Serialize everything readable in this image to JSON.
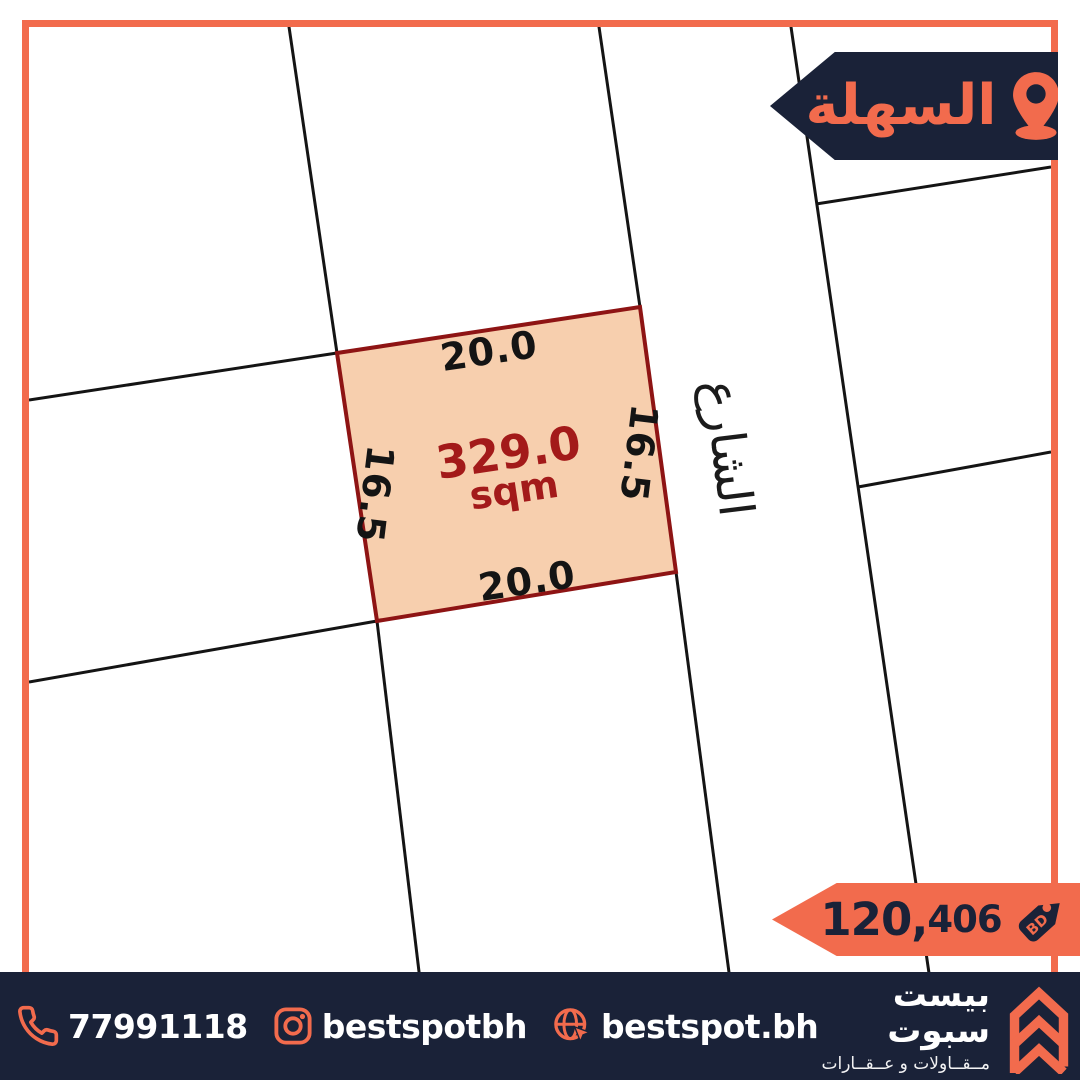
{
  "colors": {
    "accent_orange": "#f26b4d",
    "brand_navy": "#1a2238",
    "plot_fill": "#f7cfae",
    "plot_border": "#8e1414",
    "plot_text_red": "#a31a1a",
    "map_line_black": "#141414",
    "text_white": "#ffffff"
  },
  "location_badge": {
    "label": "السهلة",
    "icon": "location-pin"
  },
  "map": {
    "street_label": "الشارع",
    "plot": {
      "area_value": "329.0",
      "area_unit": "sqm",
      "dim_top": "20.0",
      "dim_bottom": "20.0",
      "dim_left": "16.5",
      "dim_right": "16.5"
    }
  },
  "price_badge": {
    "amount_major": "120,",
    "amount_minor": "406",
    "currency": "BD",
    "icon": "price-tag"
  },
  "footer": {
    "phone": "77991118",
    "phone_icon": "phone-handset",
    "instagram": "bestspotbh",
    "instagram_icon": "instagram",
    "website": "bestspot.bh",
    "website_icon": "globe-cursor",
    "brand_name": "بيست سبوت",
    "brand_tagline": "مــقــاولات و عــقــارات",
    "brand_icon": "double-chevron-logo"
  }
}
